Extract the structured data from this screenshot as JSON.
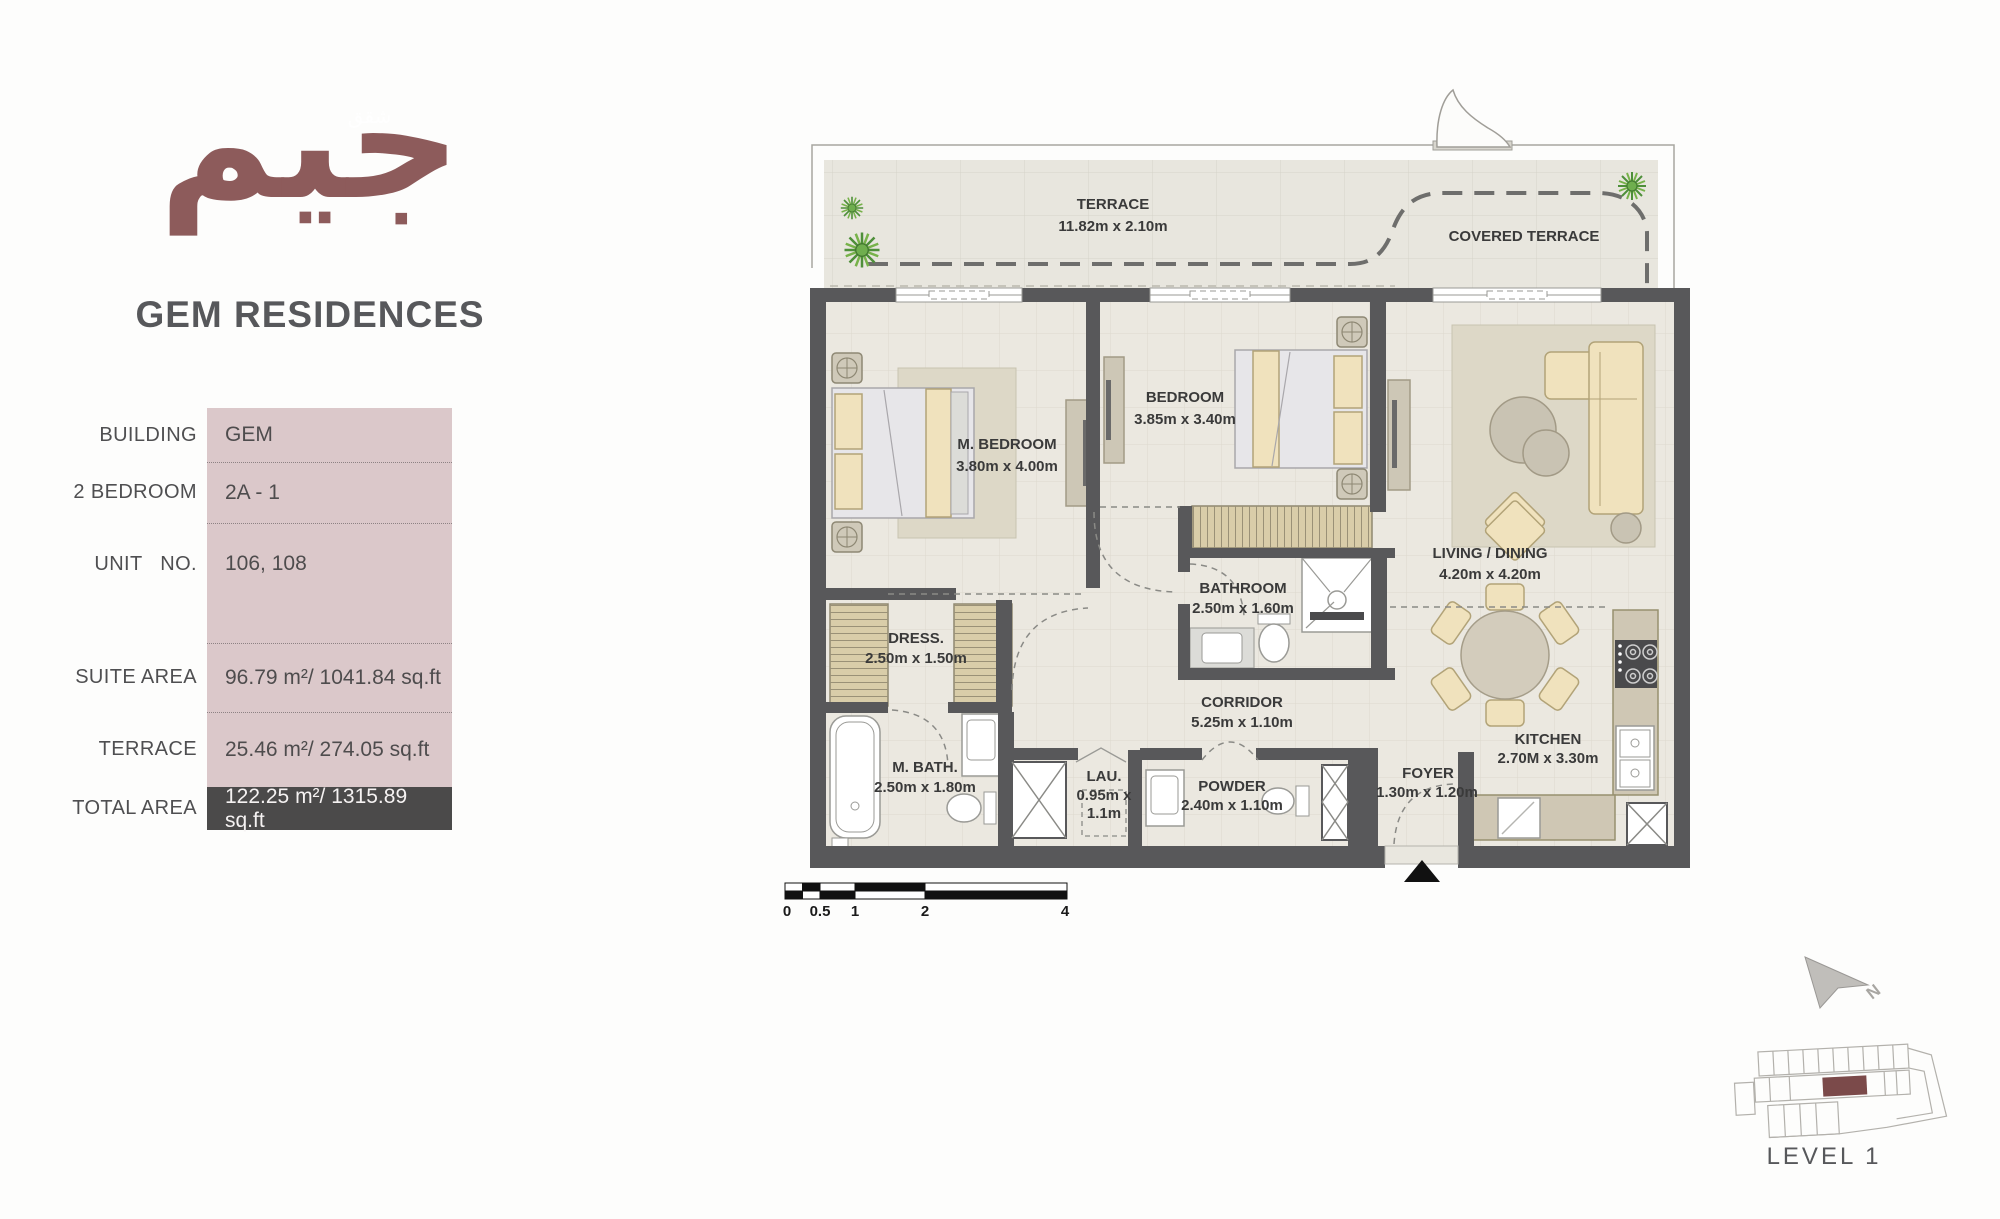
{
  "brand": {
    "logo_arabic": "جيم",
    "logo_overlay": "شقق",
    "title": "GEM RESIDENCES"
  },
  "unit_info": {
    "rows": [
      {
        "label": "BUILDING",
        "value": "GEM"
      },
      {
        "label": "2 BEDROOM",
        "value": "2A - 1"
      },
      {
        "label": "UNIT NO.",
        "value": "106, 108"
      },
      {
        "label": "SUITE AREA",
        "value": "96.79 m²/ 1041.84  sq.ft"
      },
      {
        "label": "TERRACE",
        "value": "25.46 m²/ 274.05  sq.ft"
      },
      {
        "label": "TOTAL AREA",
        "value": "122.25 m²/ 1315.89 sq.ft"
      }
    ]
  },
  "floor_plan": {
    "rooms": [
      {
        "name": "TERRACE",
        "dims": "11.82m x 2.10m"
      },
      {
        "name": "COVERED TERRACE",
        "dims": ""
      },
      {
        "name": "M. BEDROOM",
        "dims": "3.80m x 4.00m"
      },
      {
        "name": "BEDROOM",
        "dims": "3.85m x 3.40m"
      },
      {
        "name": "LIVING / DINING",
        "dims": "4.20m x 4.20m"
      },
      {
        "name": "BATHROOM",
        "dims": "2.50m x 1.60m"
      },
      {
        "name": "DRESS.",
        "dims": "2.50m x 1.50m"
      },
      {
        "name": "CORRIDOR",
        "dims": "5.25m x 1.10m"
      },
      {
        "name": "M. BATH.",
        "dims": "2.50m x 1.80m"
      },
      {
        "name": "LAU.",
        "dims": "0.95m x",
        "dims2": "1.1m"
      },
      {
        "name": "POWDER",
        "dims": "2.40m x 1.10m"
      },
      {
        "name": "FOYER",
        "dims": "1.30m x 1.20m"
      },
      {
        "name": "KITCHEN",
        "dims": "2.70M x 3.30m"
      }
    ],
    "scale_bar": {
      "ticks": [
        "0",
        "0.5",
        "1",
        "2",
        "4"
      ]
    },
    "north_label": "N",
    "level_label": "LEVEL 1"
  },
  "colors": {
    "logo-red": "#8d5b5b",
    "title-gray": "#57585b",
    "table-pink": "#dbc8ca",
    "table-dark": "#4b4a4a",
    "wall-gray": "#58585a",
    "highlight-red": "#7b4a4a"
  }
}
